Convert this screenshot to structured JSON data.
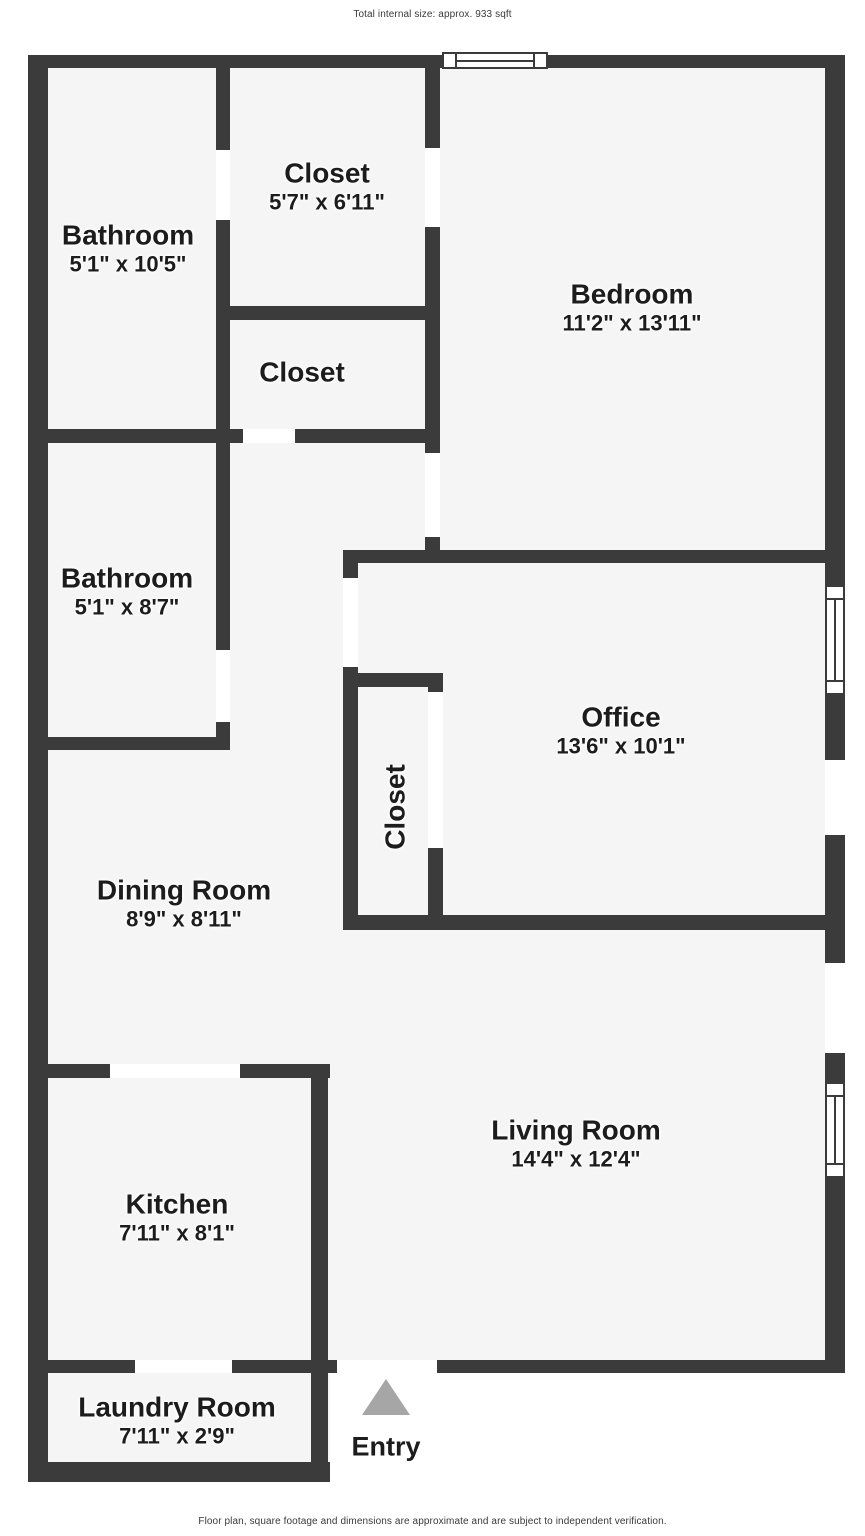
{
  "header": {
    "title": "Total internal size: approx. 933 sqft"
  },
  "footer": {
    "disclaimer": "Floor plan, square footage and dimensions are approximate and are subject to independent verification."
  },
  "colors": {
    "wall": "#3b3b3b",
    "floor": "#f5f5f5",
    "outside": "#ffffff",
    "entry_arrow": "#a6a6a6",
    "label_text": "#1c1c1c"
  },
  "rooms": [
    {
      "id": "bathroom-1",
      "name": "Bathroom",
      "dimensions": "5'1\" x 10'5\""
    },
    {
      "id": "closet-1",
      "name": "Closet",
      "dimensions": "5'7\" x 6'11\""
    },
    {
      "id": "bedroom",
      "name": "Bedroom",
      "dimensions": "11'2\" x 13'11\""
    },
    {
      "id": "closet-2",
      "name": "Closet",
      "dimensions": ""
    },
    {
      "id": "bathroom-2",
      "name": "Bathroom",
      "dimensions": "5'1\" x 8'7\""
    },
    {
      "id": "office",
      "name": "Office",
      "dimensions": "13'6\" x 10'1\""
    },
    {
      "id": "closet-3",
      "name": "Closet",
      "dimensions": ""
    },
    {
      "id": "dining-room",
      "name": "Dining Room",
      "dimensions": "8'9\" x 8'11\""
    },
    {
      "id": "living-room",
      "name": "Living Room",
      "dimensions": "14'4\" x 12'4\""
    },
    {
      "id": "kitchen",
      "name": "Kitchen",
      "dimensions": "7'11\" x 8'1\""
    },
    {
      "id": "laundry",
      "name": "Laundry Room",
      "dimensions": "7'11\" x 2'9\""
    }
  ],
  "entry": {
    "label": "Entry"
  }
}
